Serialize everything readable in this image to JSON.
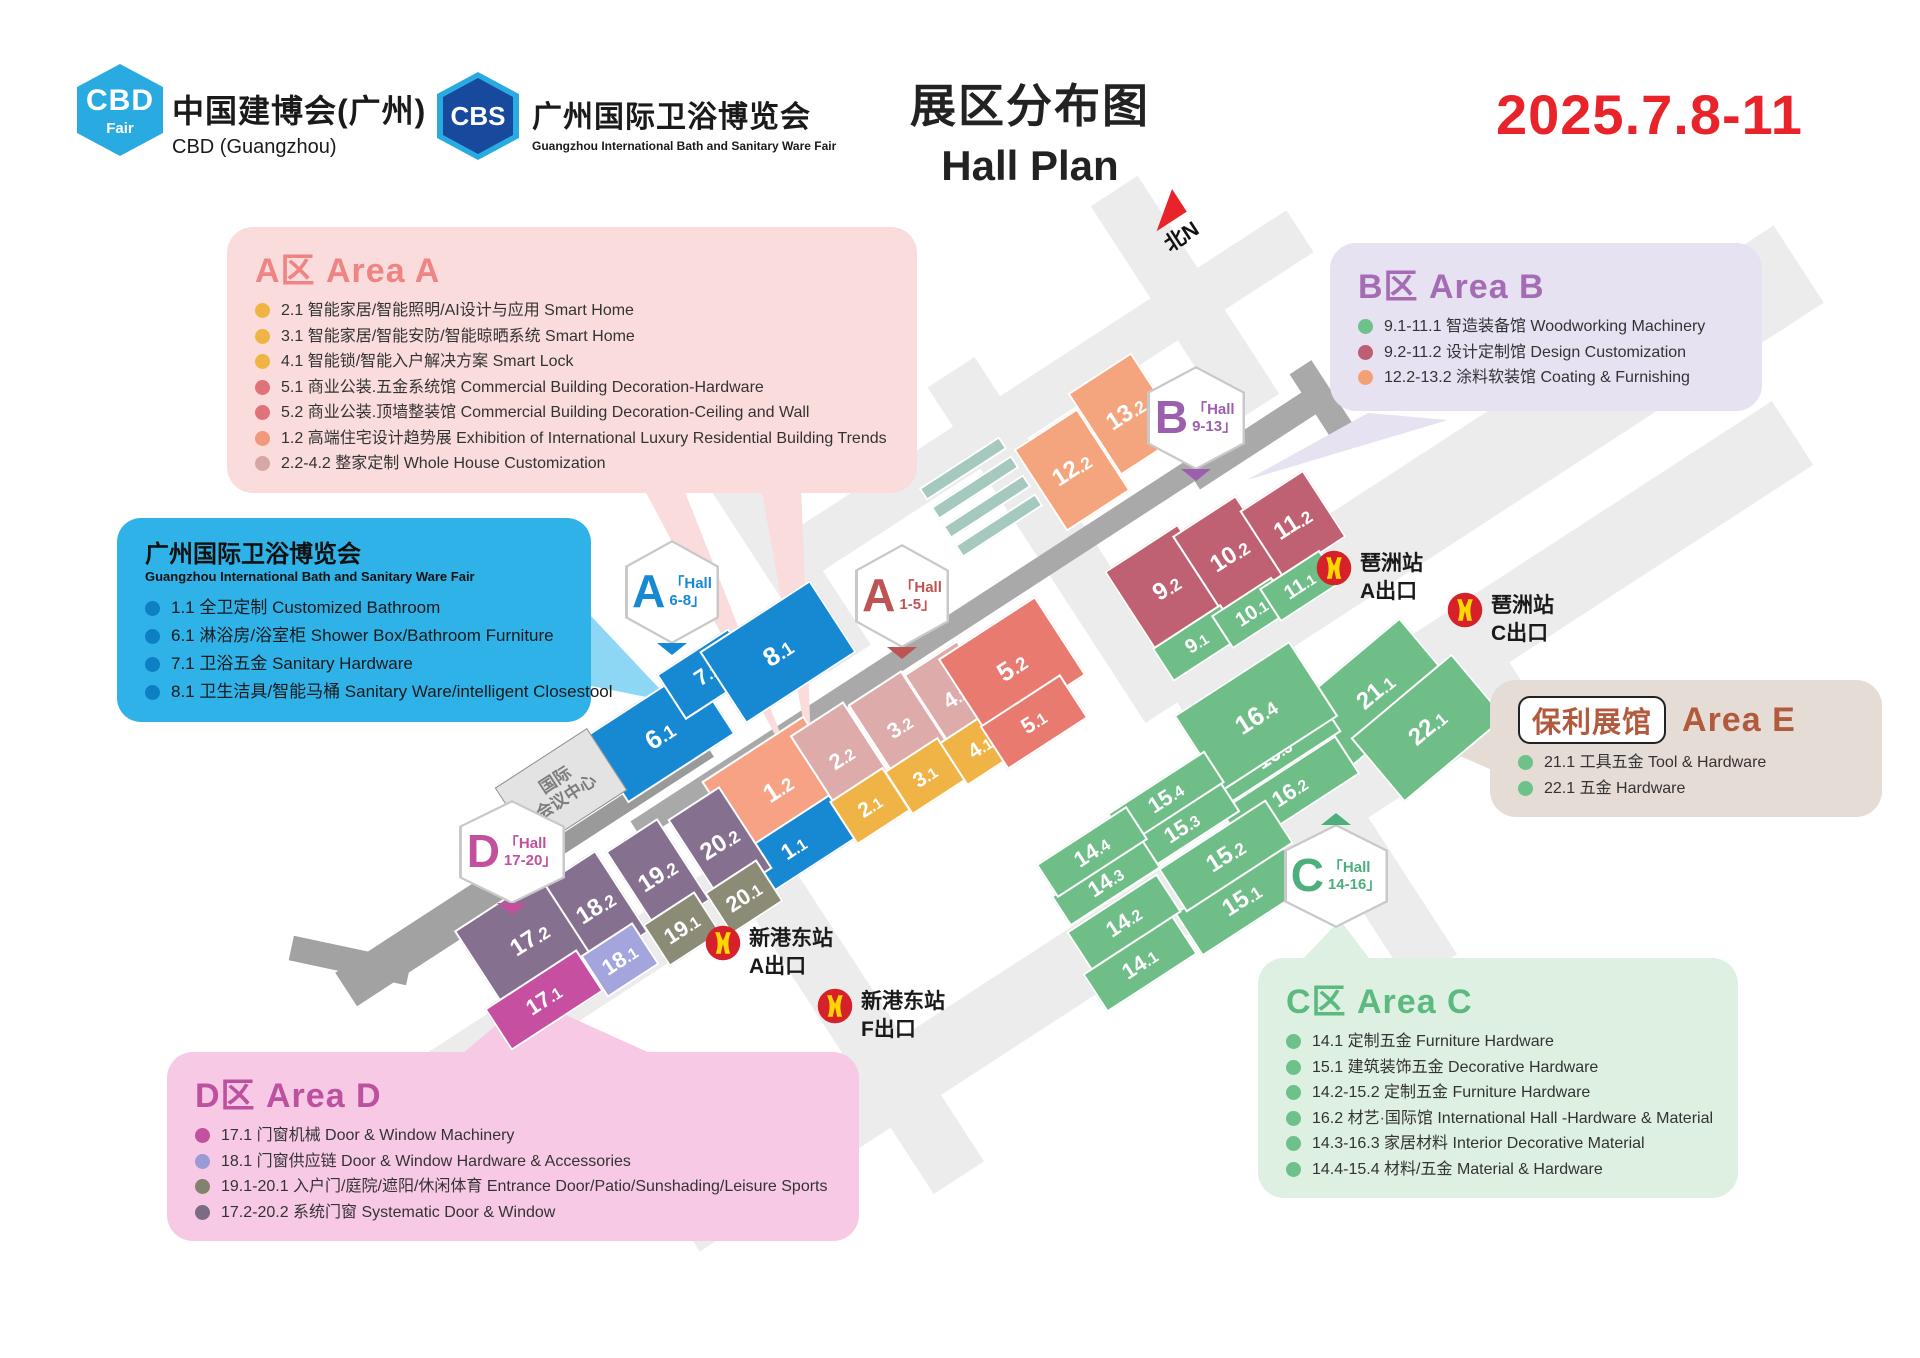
{
  "header": {
    "cbd_logo": {
      "acronym": "CBD",
      "word": "Fair"
    },
    "cbd_name_cn": "中国建博会(广州)",
    "cbd_name_en": "CBD (Guangzhou)",
    "cbs_logo": {
      "acronym": "CBS"
    },
    "cbs_name_cn": "广州国际卫浴博览会",
    "cbs_name_en": "Guangzhou International Bath and Sanitary Ware Fair",
    "title_cn": "展区分布图",
    "title_en": "Hall Plan",
    "date": "2025.7.8-11",
    "date_color": "#e8232a"
  },
  "legends": {
    "area_a": {
      "title": "A区 Area A",
      "accent": "#ee8484",
      "items": [
        {
          "dot": "#efb542",
          "text": "2.1 智能家居/智能照明/AI设计与应用 Smart Home"
        },
        {
          "dot": "#efb542",
          "text": "3.1 智能家居/智能安防/智能晾晒系统 Smart Home"
        },
        {
          "dot": "#efb542",
          "text": "4.1 智能锁/智能入户解决方案 Smart Lock"
        },
        {
          "dot": "#e0737a",
          "text": "5.1 商业公装.五金系统馆 Commercial Building Decoration-Hardware"
        },
        {
          "dot": "#e0737a",
          "text": "5.2 商业公装.顶墙整装馆 Commercial Building Decoration-Ceiling and Wall"
        },
        {
          "dot": "#f2997b",
          "text": "1.2 高端住宅设计趋势展 Exhibition of International Luxury Residential Building Trends"
        },
        {
          "dot": "#d5a7a5",
          "text": "2.2-4.2 整家定制 Whole House Customization"
        }
      ]
    },
    "area_b": {
      "title": "B区 Area B",
      "accent": "#a56cb4",
      "items": [
        {
          "dot": "#6ec189",
          "text": "9.1-11.1 智造装备馆 Woodworking Machinery"
        },
        {
          "dot": "#bd5e72",
          "text": "9.2-11.2 设计定制馆 Design Customization"
        },
        {
          "dot": "#f3a077",
          "text": "12.2-13.2 涂料软装馆 Coating & Furnishing"
        }
      ]
    },
    "bath_fair": {
      "title": "广州国际卫浴博览会",
      "subtitle": "Guangzhou International Bath and Sanitary Ware Fair",
      "items": [
        {
          "dot": "#0d80c4",
          "text": "1.1 全卫定制 Customized Bathroom"
        },
        {
          "dot": "#0d80c4",
          "text": "6.1 淋浴房/浴室柜 Shower Box/Bathroom Furniture"
        },
        {
          "dot": "#0d80c4",
          "text": "7.1 卫浴五金 Sanitary Hardware"
        },
        {
          "dot": "#0d80c4",
          "text": "8.1 卫生洁具/智能马桶 Sanitary Ware/intelligent Closestool"
        }
      ]
    },
    "area_e": {
      "badge": "保利展馆",
      "title": "Area E",
      "accent": "#b25a3e",
      "items": [
        {
          "dot": "#6ec189",
          "text": "21.1 工具五金 Tool & Hardware"
        },
        {
          "dot": "#6ec189",
          "text": "22.1 五金 Hardware"
        }
      ]
    },
    "area_c": {
      "title": "C区 Area C",
      "accent": "#5cb97f",
      "items": [
        {
          "dot": "#6ec189",
          "text": "14.1 定制五金 Furniture Hardware"
        },
        {
          "dot": "#6ec189",
          "text": "15.1 建筑装饰五金 Decorative Hardware"
        },
        {
          "dot": "#6ec189",
          "text": "14.2-15.2 定制五金 Furniture Hardware"
        },
        {
          "dot": "#6ec189",
          "text": "16.2 材艺·国际馆 International Hall -Hardware & Material"
        },
        {
          "dot": "#6ec189",
          "text": "14.3-16.3 家居材料 Interior Decorative Material"
        },
        {
          "dot": "#6ec189",
          "text": "14.4-15.4 材料/五金 Material & Hardware"
        }
      ]
    },
    "area_d": {
      "title": "D区 Area D",
      "accent": "#bc529f",
      "items": [
        {
          "dot": "#c4519f",
          "text": "17.1 门窗机械 Door & Window Machinery"
        },
        {
          "dot": "#9a9bd4",
          "text": "18.1 门窗供应链 Door & Window Hardware & Accessories"
        },
        {
          "dot": "#83836d",
          "text": "19.1-20.1 入户门/庭院/遮阳/休闲体育 Entrance Door/Patio/Sunshading/Leisure Sports"
        },
        {
          "dot": "#7c6b85",
          "text": "17.2-20.2 系统门窗 Systematic Door & Window"
        }
      ]
    }
  },
  "map": {
    "north_label": "北N",
    "convention_center_line1": "国际",
    "convention_center_line2": "会议中心",
    "rotation": -33,
    "hex_badges": [
      {
        "letter": "A",
        "line1": "「Hall",
        "line2": "6-8」",
        "color": "#1789d3",
        "cx": 672,
        "cy": 592,
        "pointer": "bottom"
      },
      {
        "letter": "A",
        "line1": "「Hall",
        "line2": "1-5」",
        "color": "#bd5353",
        "cx": 902,
        "cy": 596,
        "pointer": "bottom"
      },
      {
        "letter": "B",
        "line1": "「Hall",
        "line2": "9-13」",
        "color": "#9c5fad",
        "cx": 1196,
        "cy": 418,
        "pointer": "bottom",
        "w": 98
      },
      {
        "letter": "D",
        "line1": "「Hall",
        "line2": "17-20」",
        "color": "#c2509d",
        "cx": 512,
        "cy": 852,
        "pointer": "bottom",
        "w": 106
      },
      {
        "letter": "C",
        "line1": "「Hall",
        "line2": "14-16」",
        "color": "#4daf7c",
        "cx": 1336,
        "cy": 876,
        "pointer": "top",
        "w": 104
      }
    ],
    "halls": [
      {
        "label": "",
        "cx": 963,
        "cy": 468,
        "w": 96,
        "h": 15,
        "color": "#a5c8bf"
      },
      {
        "label": "",
        "cx": 975,
        "cy": 487,
        "w": 96,
        "h": 15,
        "color": "#a5c8bf"
      },
      {
        "label": "",
        "cx": 987,
        "cy": 506,
        "w": 96,
        "h": 15,
        "color": "#a5c8bf"
      },
      {
        "label": "",
        "cx": 999,
        "cy": 525,
        "w": 96,
        "h": 15,
        "color": "#a5c8bf"
      },
      {
        "label": "12.2",
        "cx": 1072,
        "cy": 470,
        "w": 76,
        "h": 98,
        "color": "#f5a57e",
        "fs": 24
      },
      {
        "label": "13.2",
        "cx": 1126,
        "cy": 414,
        "w": 76,
        "h": 98,
        "color": "#f5a57e",
        "fs": 24
      },
      {
        "label": "9.2",
        "cx": 1167,
        "cy": 588,
        "w": 88,
        "h": 96,
        "color": "#c06073",
        "fs": 24
      },
      {
        "label": "10.2",
        "cx": 1230,
        "cy": 556,
        "w": 76,
        "h": 96,
        "color": "#c06073",
        "fs": 24
      },
      {
        "label": "11.2",
        "cx": 1293,
        "cy": 524,
        "w": 76,
        "h": 80,
        "color": "#c06073",
        "fs": 24
      },
      {
        "label": "9.1",
        "cx": 1197,
        "cy": 643,
        "w": 82,
        "h": 40,
        "color": "#6fbe88",
        "fs": 20
      },
      {
        "label": "10.1",
        "cx": 1252,
        "cy": 613,
        "w": 72,
        "h": 40,
        "color": "#6fbe88",
        "fs": 20
      },
      {
        "label": "11.1",
        "cx": 1300,
        "cy": 586,
        "w": 72,
        "h": 40,
        "color": "#6fbe88",
        "fs": 20
      },
      {
        "label": "6.1",
        "cx": 660,
        "cy": 735,
        "w": 128,
        "h": 80,
        "color": "#1789d3",
        "fs": 26
      },
      {
        "label": "7.1",
        "cx": 707,
        "cy": 674,
        "w": 86,
        "h": 54,
        "color": "#1789d3",
        "fs": 22
      },
      {
        "label": "8.1",
        "cx": 778,
        "cy": 652,
        "w": 132,
        "h": 86,
        "color": "#1789d3",
        "fs": 26
      },
      {
        "label": "1.2",
        "cx": 778,
        "cy": 788,
        "w": 122,
        "h": 94,
        "color": "#f8a285",
        "fs": 26
      },
      {
        "label": "2.2",
        "cx": 842,
        "cy": 758,
        "w": 64,
        "h": 94,
        "color": "#dcabaa",
        "fs": 22
      },
      {
        "label": "3.2",
        "cx": 900,
        "cy": 727,
        "w": 64,
        "h": 94,
        "color": "#dcabaa",
        "fs": 22
      },
      {
        "label": "4.2",
        "cx": 956,
        "cy": 697,
        "w": 64,
        "h": 94,
        "color": "#dcabaa",
        "fs": 22
      },
      {
        "label": "1.1",
        "cx": 794,
        "cy": 848,
        "w": 118,
        "h": 52,
        "color": "#1789d3",
        "fs": 22
      },
      {
        "label": "2.1",
        "cx": 870,
        "cy": 806,
        "w": 64,
        "h": 52,
        "color": "#f0b446",
        "fs": 21
      },
      {
        "label": "3.1",
        "cx": 925,
        "cy": 776,
        "w": 64,
        "h": 52,
        "color": "#f0b446",
        "fs": 21
      },
      {
        "label": "4.1",
        "cx": 980,
        "cy": 747,
        "w": 64,
        "h": 52,
        "color": "#f0b446",
        "fs": 21
      },
      {
        "label": "5.2",
        "cx": 1012,
        "cy": 667,
        "w": 116,
        "h": 94,
        "color": "#e87a70",
        "fs": 26
      },
      {
        "label": "5.1",
        "cx": 1034,
        "cy": 722,
        "w": 96,
        "h": 52,
        "color": "#e87a70",
        "fs": 22
      },
      {
        "label": "17.2",
        "cx": 530,
        "cy": 940,
        "w": 118,
        "h": 98,
        "color": "#857090",
        "fs": 24
      },
      {
        "label": "18.2",
        "cx": 596,
        "cy": 908,
        "w": 62,
        "h": 98,
        "color": "#857090",
        "fs": 24
      },
      {
        "label": "19.2",
        "cx": 658,
        "cy": 876,
        "w": 62,
        "h": 98,
        "color": "#857090",
        "fs": 24
      },
      {
        "label": "20.2",
        "cx": 720,
        "cy": 844,
        "w": 62,
        "h": 98,
        "color": "#857090",
        "fs": 24
      },
      {
        "label": "17.1",
        "cx": 544,
        "cy": 1000,
        "w": 110,
        "h": 50,
        "color": "#c74fa2",
        "fs": 22
      },
      {
        "label": "18.1",
        "cx": 620,
        "cy": 960,
        "w": 62,
        "h": 50,
        "color": "#a4a5dc",
        "fs": 22
      },
      {
        "label": "19.1",
        "cx": 682,
        "cy": 929,
        "w": 62,
        "h": 50,
        "color": "#8c8c76",
        "fs": 22
      },
      {
        "label": "20.1",
        "cx": 744,
        "cy": 897,
        "w": 62,
        "h": 50,
        "color": "#8c8c76",
        "fs": 22
      },
      {
        "label": "21.1",
        "cx": 1376,
        "cy": 692,
        "w": 132,
        "h": 84,
        "color": "#6fbe88",
        "fs": 24,
        "rot": -40
      },
      {
        "label": "22.1",
        "cx": 1428,
        "cy": 728,
        "w": 132,
        "h": 84,
        "color": "#6fbe88",
        "fs": 24,
        "rot": -40
      },
      {
        "label": "16.2",
        "cx": 1290,
        "cy": 792,
        "w": 138,
        "h": 46,
        "color": "#6fbe88",
        "fs": 22
      },
      {
        "label": "16.3",
        "cx": 1274,
        "cy": 754,
        "w": 138,
        "h": 36,
        "color": "#6fbe88",
        "fs": 22
      },
      {
        "label": "16.4",
        "cx": 1256,
        "cy": 716,
        "w": 138,
        "h": 90,
        "color": "#6fbe88",
        "fs": 26
      },
      {
        "label": "15.3",
        "cx": 1182,
        "cy": 828,
        "w": 116,
        "h": 36,
        "color": "#6fbe88",
        "fs": 22
      },
      {
        "label": "15.4",
        "cx": 1166,
        "cy": 798,
        "w": 116,
        "h": 38,
        "color": "#6fbe88",
        "fs": 22
      },
      {
        "label": "15.1",
        "cx": 1242,
        "cy": 900,
        "w": 128,
        "h": 52,
        "color": "#6fbe88",
        "fs": 24
      },
      {
        "label": "15.2",
        "cx": 1226,
        "cy": 856,
        "w": 128,
        "h": 52,
        "color": "#6fbe88",
        "fs": 24
      },
      {
        "label": "14.3",
        "cx": 1106,
        "cy": 882,
        "w": 108,
        "h": 36,
        "color": "#6fbe88",
        "fs": 22
      },
      {
        "label": "14.4",
        "cx": 1092,
        "cy": 852,
        "w": 108,
        "h": 40,
        "color": "#6fbe88",
        "fs": 22
      },
      {
        "label": "14.1",
        "cx": 1140,
        "cy": 964,
        "w": 108,
        "h": 46,
        "color": "#6fbe88",
        "fs": 22
      },
      {
        "label": "14.2",
        "cx": 1124,
        "cy": 922,
        "w": 108,
        "h": 46,
        "color": "#6fbe88",
        "fs": 22
      }
    ],
    "metro_stations": [
      {
        "station": "琶洲站",
        "exit": "A出口",
        "x": 1316,
        "y": 550
      },
      {
        "station": "琶洲站",
        "exit": "C出口",
        "x": 1447,
        "y": 592
      },
      {
        "station": "新港东站",
        "exit": "A出口",
        "x": 705,
        "y": 925
      },
      {
        "station": "新港东站",
        "exit": "F出口",
        "x": 817,
        "y": 988
      }
    ]
  }
}
